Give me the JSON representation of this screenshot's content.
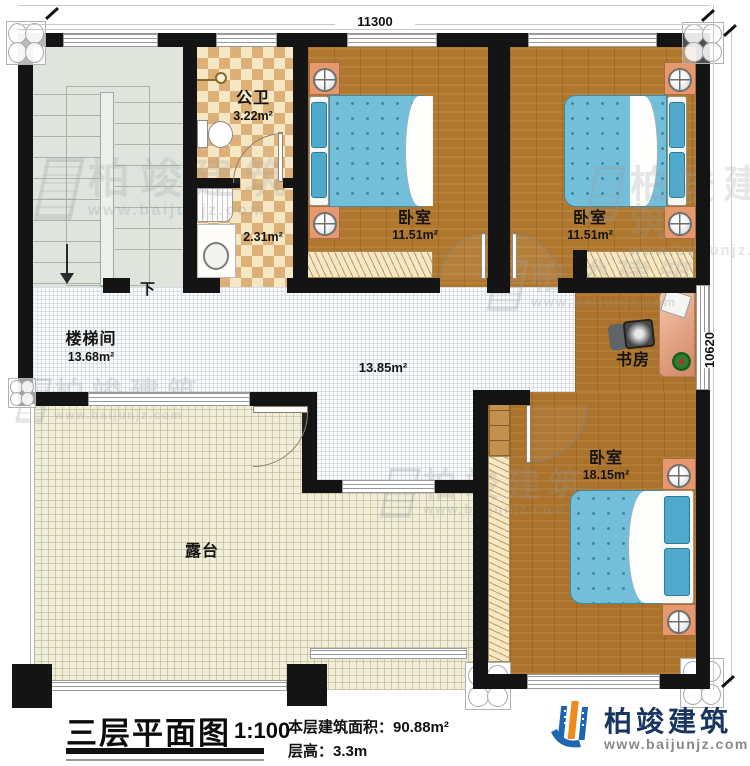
{
  "dimensions": {
    "width_label": "11300",
    "height_label": "10620"
  },
  "rooms": {
    "bathroom": {
      "name": "公卫",
      "area": "3.22m²"
    },
    "bath_anteroom": {
      "area": "2.31m²"
    },
    "bedroom_left": {
      "name": "卧室",
      "area": "11.51m²"
    },
    "bedroom_right": {
      "name": "卧室",
      "area": "11.51m²"
    },
    "stairwell": {
      "name": "楼梯间",
      "area": "13.68m²",
      "direction_label": "下"
    },
    "hallway": {
      "area": "13.85m²"
    },
    "study": {
      "name": "书房"
    },
    "bedroom_large": {
      "name": "卧室",
      "area": "18.15m²"
    },
    "terrace": {
      "name": "露台"
    }
  },
  "title_block": {
    "title": "三层平面图",
    "scale": "1:100",
    "floor_area_label": "本层建筑面积：",
    "floor_area_value": "90.88m²",
    "floor_height_label": "层高：",
    "floor_height_value": "3.3m"
  },
  "brand": {
    "name": "柏竣建筑",
    "website": "www.baijunjz.com"
  },
  "watermark": {
    "text": "柏竣建筑",
    "url": "www.baijunjz.com"
  },
  "colors": {
    "wall": "#141414",
    "wood": "#b0772e",
    "bed": "#73bfd9",
    "terrace": "#f0edd8",
    "tile_light": "#f5e7c3",
    "tile_dark": "#dcb077",
    "stair": "#dfe5dc",
    "furniture_accent": "#e6976b",
    "brand_navy": "#17355e",
    "brand_blue": "#1f66b0",
    "brand_orange": "#f08a1e"
  }
}
